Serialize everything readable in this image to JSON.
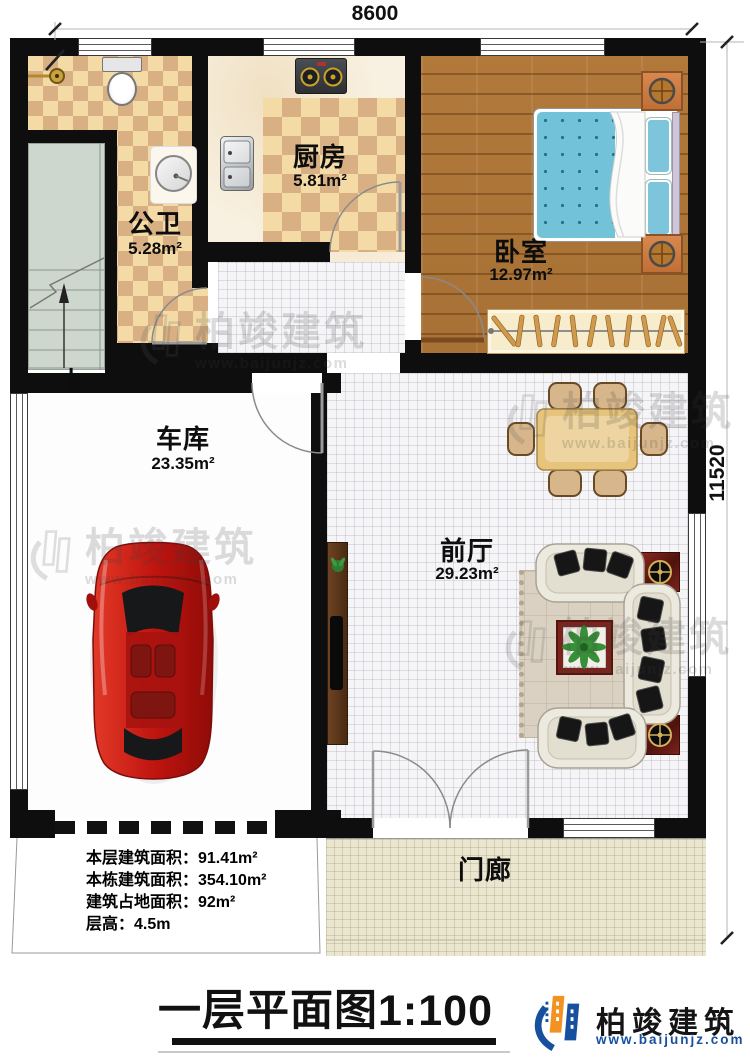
{
  "plan": {
    "dim_top": "8600",
    "dim_right": "11520",
    "rooms": {
      "bathroom": {
        "name": "公卫",
        "area": "5.28m²"
      },
      "kitchen": {
        "name": "厨房",
        "area": "5.81m²"
      },
      "bedroom": {
        "name": "卧室",
        "area": "12.97m²"
      },
      "garage": {
        "name": "车库",
        "area": "23.35m²"
      },
      "hall": {
        "name": "前厅",
        "area": "29.23m²"
      },
      "porch": {
        "name": "门廊"
      },
      "stairs_up": "上"
    },
    "info": {
      "items": [
        "本层建筑面积：91.41m²",
        "本栋建筑面积：354.10m²",
        "建筑占地面积：92m²",
        "层高：4.5m"
      ]
    },
    "title": {
      "text": "一层平面图",
      "scale": "1:100"
    }
  },
  "brand": {
    "name": "柏竣建筑",
    "url": "www.baijunjz.com"
  },
  "watermark": {
    "name": "柏竣建筑",
    "url": "www.baijunjz.com"
  },
  "colors": {
    "wall": "#0e0e0e",
    "brand_blue": "#17509e",
    "brand_orange": "#f29222",
    "bed_cyan": "#72c2d8",
    "car_red": "#c11510",
    "tile_tan": "#d8b084"
  }
}
